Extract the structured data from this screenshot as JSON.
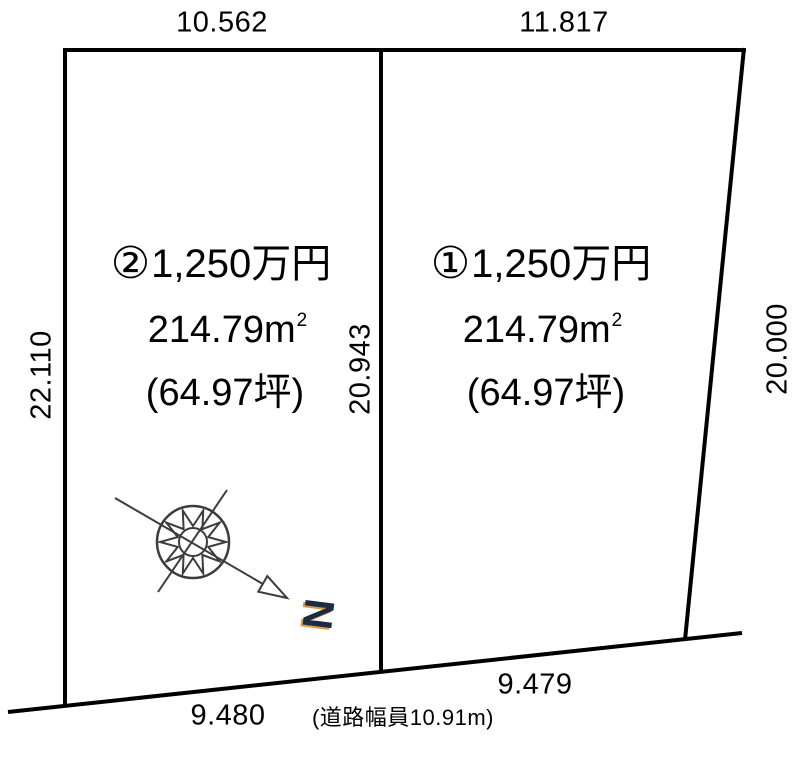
{
  "diagram": {
    "dimensions": {
      "top_left": "10.562",
      "top_right": "11.817",
      "left": "22.110",
      "center": "20.943",
      "right": "20.000",
      "bottom_left": "9.480",
      "bottom_right": "9.479",
      "road_note": "(道路幅員10.91m)"
    },
    "left_plot": {
      "number": "②",
      "price": "1,250万円",
      "area_sqm": "214.79m",
      "area_sqm_sup": "2",
      "area_tsubo": "(64.97坪)"
    },
    "right_plot": {
      "number": "①",
      "price": "1,250万円",
      "area_sqm": "214.79m",
      "area_sqm_sup": "2",
      "area_tsubo": "(64.97坪)"
    },
    "compass": {
      "north_label": "N"
    },
    "colors": {
      "background": "#ffffff",
      "boundary_line": "#000000",
      "compass_line": "#3c3c3c",
      "north_letter": "#1c2b45",
      "north_shadow": "#e09a40"
    }
  }
}
